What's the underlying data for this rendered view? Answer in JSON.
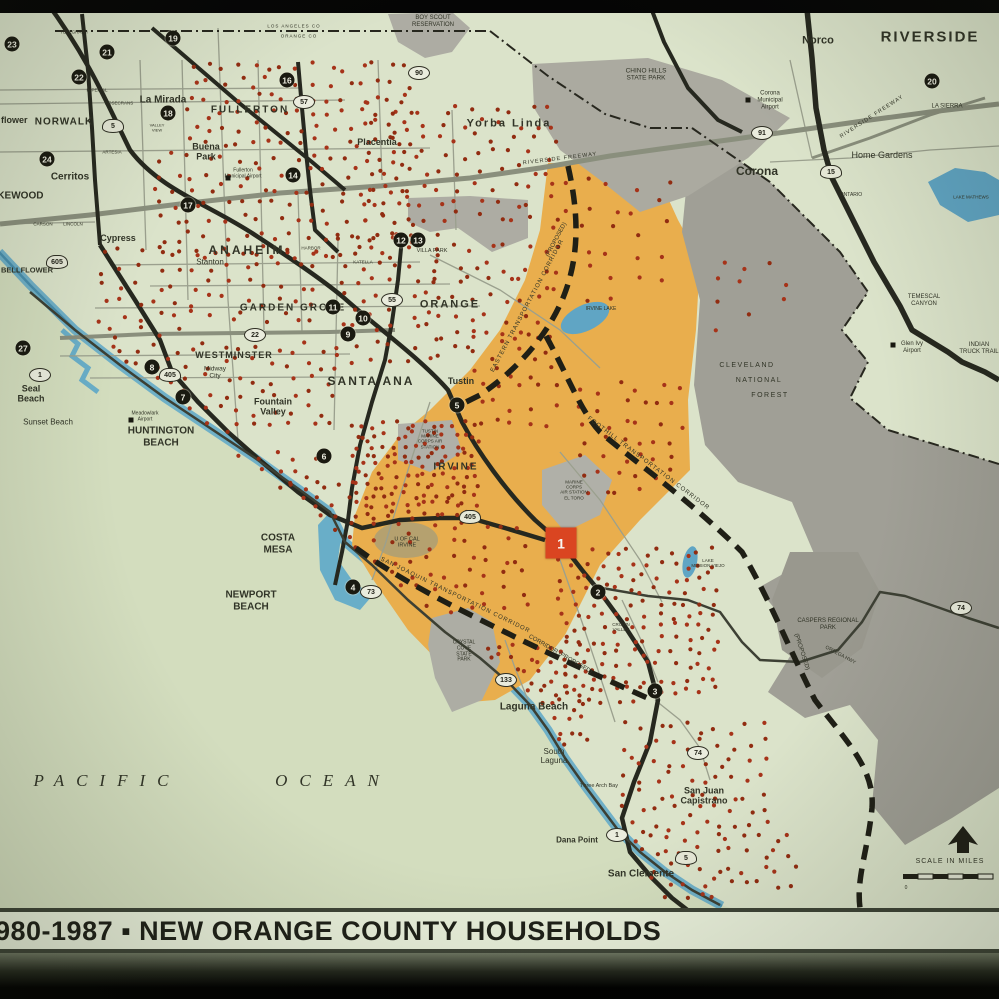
{
  "slide": {
    "title": "980-1987 ▪ NEW ORANGE COUNTY HOUSEHOLDS"
  },
  "map": {
    "colors": {
      "land": "#e1e9d2",
      "ocean": "#d8e3c6",
      "coast_blue": "#69b1d0",
      "coast_blue_dark": "#4690b4",
      "study_area_orange": "#f0b14e",
      "forest_gray": "#a3a29b",
      "park_gray": "#aeada6",
      "base_gray": "#b4b4ae",
      "lake_blue": "#5fa8cc",
      "dot_red": "#a93018",
      "freeway_black": "#22241e",
      "freeway_gray": "#8c9181",
      "marker_black": "#16160f",
      "site1_red": "#e04320",
      "band_bg": "#e7eed9"
    },
    "scale": {
      "label": "SCALE IN MILES",
      "zero": "0"
    },
    "special_marker": {
      "n": "1",
      "x": 561,
      "y": 543
    },
    "markers": [
      {
        "n": "2",
        "x": 598,
        "y": 592
      },
      {
        "n": "3",
        "x": 655,
        "y": 691
      },
      {
        "n": "4",
        "x": 353,
        "y": 587
      },
      {
        "n": "5",
        "x": 457,
        "y": 405
      },
      {
        "n": "6",
        "x": 324,
        "y": 456
      },
      {
        "n": "7",
        "x": 183,
        "y": 397
      },
      {
        "n": "8",
        "x": 152,
        "y": 367
      },
      {
        "n": "9",
        "x": 348,
        "y": 334
      },
      {
        "n": "10",
        "x": 363,
        "y": 318
      },
      {
        "n": "11",
        "x": 333,
        "y": 307
      },
      {
        "n": "12",
        "x": 401,
        "y": 240
      },
      {
        "n": "13",
        "x": 418,
        "y": 240
      },
      {
        "n": "14",
        "x": 293,
        "y": 175
      },
      {
        "n": "16",
        "x": 287,
        "y": 80
      },
      {
        "n": "17",
        "x": 188,
        "y": 205
      },
      {
        "n": "18",
        "x": 168,
        "y": 113
      },
      {
        "n": "19",
        "x": 173,
        "y": 38
      },
      {
        "n": "20",
        "x": 932,
        "y": 81
      },
      {
        "n": "21",
        "x": 107,
        "y": 52
      },
      {
        "n": "22",
        "x": 79,
        "y": 77
      },
      {
        "n": "23",
        "x": 12,
        "y": 44
      },
      {
        "n": "24",
        "x": 47,
        "y": 159
      },
      {
        "n": "27",
        "x": 23,
        "y": 348
      }
    ],
    "route_shields": [
      {
        "n": "5",
        "x": 113,
        "y": 126,
        "t": "i"
      },
      {
        "n": "5",
        "x": 686,
        "y": 858,
        "t": "i"
      },
      {
        "n": "405",
        "x": 170,
        "y": 375,
        "t": "i"
      },
      {
        "n": "405",
        "x": 470,
        "y": 517,
        "t": "i"
      },
      {
        "n": "605",
        "x": 57,
        "y": 262,
        "t": "i"
      },
      {
        "n": "15",
        "x": 831,
        "y": 172,
        "t": "i"
      },
      {
        "n": "91",
        "x": 762,
        "y": 133,
        "t": "s"
      },
      {
        "n": "22",
        "x": 255,
        "y": 335,
        "t": "s"
      },
      {
        "n": "55",
        "x": 392,
        "y": 300,
        "t": "s"
      },
      {
        "n": "57",
        "x": 304,
        "y": 102,
        "t": "s"
      },
      {
        "n": "74",
        "x": 698,
        "y": 753,
        "t": "s"
      },
      {
        "n": "74",
        "x": 961,
        "y": 608,
        "t": "s"
      },
      {
        "n": "1",
        "x": 40,
        "y": 375,
        "t": "s"
      },
      {
        "n": "1",
        "x": 617,
        "y": 835,
        "t": "s"
      },
      {
        "n": "133",
        "x": 506,
        "y": 680,
        "t": "s"
      },
      {
        "n": "73",
        "x": 371,
        "y": 592,
        "t": "s"
      },
      {
        "n": "90",
        "x": 419,
        "y": 73,
        "t": "s"
      }
    ],
    "airport_icons": [
      {
        "x": 228,
        "y": 178
      },
      {
        "x": 131,
        "y": 420
      },
      {
        "x": 748,
        "y": 100
      },
      {
        "x": 893,
        "y": 345
      }
    ],
    "labels": [
      {
        "id": "riverside",
        "t": "RIVERSIDE",
        "x": 930,
        "y": 37,
        "s": 15,
        "w": 700,
        "sp": 2
      },
      {
        "id": "norco",
        "t": "Norco",
        "x": 818,
        "y": 41,
        "s": 11,
        "w": 700
      },
      {
        "id": "corona",
        "t": "Corona",
        "x": 757,
        "y": 172,
        "s": 12,
        "w": 700
      },
      {
        "id": "home-gardens",
        "t": "Home Gardens",
        "x": 882,
        "y": 155,
        "s": 9
      },
      {
        "id": "la-sierra",
        "t": "LA SIERRA",
        "x": 947,
        "y": 107,
        "s": 6
      },
      {
        "id": "ontario",
        "t": "ONTARIO",
        "x": 851,
        "y": 196,
        "s": 5
      },
      {
        "id": "corona-airport",
        "t": "Corona\nMunicipal\nAirport",
        "x": 770,
        "y": 101,
        "s": 6
      },
      {
        "id": "chino-hills-sp",
        "t": "CHINO HILLS\nSTATE PARK",
        "x": 646,
        "y": 75,
        "s": 6.5
      },
      {
        "id": "boy-scout",
        "t": "BOY SCOUT\nRESERVATION",
        "x": 433,
        "y": 22,
        "s": 6
      },
      {
        "id": "cleveland",
        "t": "CLEVELAND",
        "x": 747,
        "y": 366,
        "s": 7,
        "sp": 1.5
      },
      {
        "id": "national",
        "t": "NATIONAL",
        "x": 759,
        "y": 381,
        "s": 7,
        "sp": 1.5
      },
      {
        "id": "forest",
        "t": "FOREST",
        "x": 770,
        "y": 396,
        "s": 7,
        "sp": 1.5
      },
      {
        "id": "temescal",
        "t": "TEMESCAL\nCANYON",
        "x": 924,
        "y": 301,
        "s": 6
      },
      {
        "id": "glen-ivy",
        "t": "Glen Ivy\nAirport",
        "x": 912,
        "y": 348,
        "s": 6
      },
      {
        "id": "indian-truck",
        "t": "INDIAN\nTRUCK TRAIL",
        "x": 979,
        "y": 349,
        "s": 6
      },
      {
        "id": "lake-mathews",
        "t": "LAKE MATHEWS",
        "x": 971,
        "y": 197,
        "s": 4.5
      },
      {
        "id": "caspers",
        "t": "CASPERS REGIONAL\nPARK",
        "x": 828,
        "y": 625,
        "s": 6
      },
      {
        "id": "irvine-lake",
        "t": "IRVINE LAKE",
        "x": 601,
        "y": 310,
        "s": 5
      },
      {
        "id": "lake-mission-viejo",
        "t": "LAKE\nMISSION VIEJO",
        "x": 708,
        "y": 563,
        "s": 4.5
      },
      {
        "id": "pacific",
        "t": "PACIFIC",
        "x": 107,
        "y": 781,
        "s": 17,
        "i": 1,
        "f": "serif",
        "sp": 12
      },
      {
        "id": "ocean",
        "t": "OCEAN",
        "x": 333,
        "y": 781,
        "s": 17,
        "i": 1,
        "f": "serif",
        "sp": 12
      },
      {
        "id": "norwalk",
        "t": "NORWALK",
        "x": 64,
        "y": 122,
        "s": 10,
        "w": 700,
        "sp": 1
      },
      {
        "id": "la-mirada",
        "t": "La Mirada",
        "x": 163,
        "y": 100,
        "s": 10,
        "w": 700
      },
      {
        "id": "cerritos",
        "t": "Cerritos",
        "x": 70,
        "y": 177,
        "s": 10,
        "w": 700
      },
      {
        "id": "lakewood",
        "t": "LAKEWOOD",
        "x": -16,
        "y": 196,
        "s": 10,
        "w": 700,
        "a": "l"
      },
      {
        "id": "bellflower-cut",
        "t": "flower",
        "x": 1,
        "y": 120,
        "s": 9,
        "w": 700,
        "a": "l"
      },
      {
        "id": "bellflower",
        "t": "BELLFLOWER",
        "x": 1,
        "y": 271,
        "s": 7.5,
        "w": 700,
        "a": "l"
      },
      {
        "id": "fullerton",
        "t": "FULLERTON",
        "x": 250,
        "y": 110,
        "s": 10,
        "w": 700,
        "sp": 2
      },
      {
        "id": "buena-park",
        "t": "Buena\nPark",
        "x": 206,
        "y": 152,
        "s": 9,
        "w": 700
      },
      {
        "id": "fullerton-airport",
        "t": "Fullerton\nMunicipal Airport",
        "x": 243,
        "y": 174,
        "s": 5
      },
      {
        "id": "cypress",
        "t": "Cypress",
        "x": 118,
        "y": 238,
        "s": 9,
        "w": 700
      },
      {
        "id": "anaheim",
        "t": "ANAHEIM",
        "x": 247,
        "y": 251,
        "s": 12,
        "w": 700,
        "sp": 3
      },
      {
        "id": "stanton",
        "t": "Stanton",
        "x": 210,
        "y": 262,
        "s": 8
      },
      {
        "id": "garden-grove",
        "t": "GARDEN GROVE",
        "x": 293,
        "y": 308,
        "s": 10,
        "w": 700,
        "sp": 2
      },
      {
        "id": "orange",
        "t": "ORANGE",
        "x": 450,
        "y": 305,
        "s": 11,
        "w": 700,
        "sp": 2
      },
      {
        "id": "villa-park",
        "t": "VILLA PARK",
        "x": 432,
        "y": 251,
        "s": 5.5
      },
      {
        "id": "westminster",
        "t": "WESTMINSTER",
        "x": 234,
        "y": 355,
        "s": 9,
        "w": 700,
        "sp": 1
      },
      {
        "id": "midway-city",
        "t": "Midway\nCity",
        "x": 215,
        "y": 373,
        "s": 6.5
      },
      {
        "id": "fountain-valley",
        "t": "Fountain\nValley",
        "x": 273,
        "y": 407,
        "s": 9,
        "w": 700
      },
      {
        "id": "santa-ana",
        "t": "SANTA ANA",
        "x": 371,
        "y": 382,
        "s": 12,
        "w": 700,
        "sp": 2
      },
      {
        "id": "tustin",
        "t": "Tustin",
        "x": 461,
        "y": 381,
        "s": 9,
        "w": 700
      },
      {
        "id": "irvine",
        "t": "IRVINE",
        "x": 456,
        "y": 467,
        "s": 10,
        "w": 700,
        "sp": 2
      },
      {
        "id": "costa-mesa",
        "t": "COSTA\nMESA",
        "x": 278,
        "y": 544,
        "s": 10,
        "w": 700
      },
      {
        "id": "newport-beach",
        "t": "NEWPORT\nBEACH",
        "x": 251,
        "y": 601,
        "s": 10,
        "w": 700
      },
      {
        "id": "huntington-beach",
        "t": "HUNTINGTON\nBEACH",
        "x": 161,
        "y": 437,
        "s": 10,
        "w": 700
      },
      {
        "id": "seal-beach",
        "t": "Seal\nBeach",
        "x": 31,
        "y": 394,
        "s": 9,
        "w": 700
      },
      {
        "id": "sunset-beach",
        "t": "Sunset Beach",
        "x": 48,
        "y": 422,
        "s": 8
      },
      {
        "id": "meadowlark",
        "t": "Meadowlark\nAirport",
        "x": 145,
        "y": 417,
        "s": 5
      },
      {
        "id": "laguna-beach",
        "t": "Laguna Beach",
        "x": 534,
        "y": 707,
        "s": 10,
        "w": 700
      },
      {
        "id": "south-laguna",
        "t": "South\nLaguna",
        "x": 554,
        "y": 756,
        "s": 8
      },
      {
        "id": "three-arch-bay",
        "t": "Three Arch Bay",
        "x": 599,
        "y": 786,
        "s": 5.5
      },
      {
        "id": "dana-point",
        "t": "Dana Point",
        "x": 577,
        "y": 840,
        "s": 8,
        "w": 700
      },
      {
        "id": "san-clemente",
        "t": "San Clemente",
        "x": 641,
        "y": 874,
        "s": 10,
        "w": 700
      },
      {
        "id": "san-juan-capistrano",
        "t": "San Juan\nCapistrano",
        "x": 704,
        "y": 796,
        "s": 9,
        "w": 700
      },
      {
        "id": "yorba-linda",
        "t": "Yorba Linda",
        "x": 509,
        "y": 124,
        "s": 11,
        "w": 700,
        "sp": 2
      },
      {
        "id": "placentia",
        "t": "Placentia",
        "x": 377,
        "y": 142,
        "s": 9,
        "w": 700
      },
      {
        "id": "uc-irvine",
        "t": "U OF CAL\nIRVINE",
        "x": 407,
        "y": 543,
        "s": 5.5
      },
      {
        "id": "tustin-mcas",
        "t": "TUSTIN\nMARINE\nCORPS AIR\nSTATION",
        "x": 430,
        "y": 439,
        "s": 4.5
      },
      {
        "id": "el-toro-mcas",
        "t": "MARINE\nCORPS\nAIR STATION\nEL TORO",
        "x": 574,
        "y": 490,
        "s": 4.5
      },
      {
        "id": "crystal-cove",
        "t": "CRYSTAL\nCOVE\nSTATE\nPARK",
        "x": 464,
        "y": 652,
        "s": 5
      },
      {
        "id": "crown-valley",
        "t": "CROWN\nVALLEY",
        "x": 621,
        "y": 627,
        "s": 4.5
      },
      {
        "id": "scale-label",
        "t": "SCALE IN MILES",
        "x": 950,
        "y": 862,
        "s": 7,
        "sp": 1
      },
      {
        "id": "scale-zero",
        "t": "0",
        "x": 906,
        "y": 889,
        "s": 5
      },
      {
        "id": "eastern-corridor",
        "t": "EASTERN TRANSPORTATION CORRIDOR",
        "x": 528,
        "y": 306,
        "s": 6,
        "r": -62,
        "sp": 1
      },
      {
        "id": "eastern-proposed",
        "t": "(PROPOSED)",
        "x": 557,
        "y": 240,
        "s": 6,
        "r": -62
      },
      {
        "id": "foothill-corridor",
        "t": "FOOTHILL TRANSPORTATION CORRIDOR",
        "x": 648,
        "y": 464,
        "s": 6,
        "r": 37,
        "sp": 1
      },
      {
        "id": "foothill-proposed",
        "t": "(PROPOSED)",
        "x": 801,
        "y": 652,
        "s": 6,
        "r": 72
      },
      {
        "id": "san-joaquin-corridor",
        "t": "SAN JOAQUIN TRANSPORTATION CORRIDOR",
        "x": 455,
        "y": 596,
        "s": 6,
        "r": 26,
        "sp": 1
      },
      {
        "id": "sj-proposed",
        "t": "CORRIDOR (PROPOSED)",
        "x": 560,
        "y": 655,
        "s": 6,
        "r": 30
      },
      {
        "id": "riverside-fwy-1",
        "t": "RIVERSIDE FREEWAY",
        "x": 560,
        "y": 159,
        "s": 5.5,
        "r": -7,
        "sp": 1
      },
      {
        "id": "riverside-fwy-2",
        "t": "RIVERSIDE FREEWAY",
        "x": 872,
        "y": 117,
        "s": 5.5,
        "r": -33,
        "sp": 1
      },
      {
        "id": "ortega-hwy",
        "t": "ORTEGA HWY",
        "x": 840,
        "y": 656,
        "s": 5,
        "r": 28
      },
      {
        "id": "la-county",
        "t": "LOS ANGELES CO",
        "x": 294,
        "y": 26,
        "s": 4.5,
        "sp": 1
      },
      {
        "id": "orange-county",
        "t": "ORANGE CO",
        "x": 299,
        "y": 36,
        "s": 4.5,
        "sp": 1
      },
      {
        "id": "st-imperial",
        "t": "IMPERIAL",
        "x": 97,
        "y": 90,
        "s": 4.5
      },
      {
        "id": "st-rosecrans",
        "t": "ROSECRANS",
        "x": 119,
        "y": 103,
        "s": 4.5
      },
      {
        "id": "st-artesia",
        "t": "ARTESIA",
        "x": 112,
        "y": 152,
        "s": 4.5
      },
      {
        "id": "st-carson",
        "t": "CARSON",
        "x": 43,
        "y": 224,
        "s": 4.5
      },
      {
        "id": "st-lincoln",
        "t": "LINCOLN",
        "x": 73,
        "y": 224,
        "s": 4.5
      },
      {
        "id": "st-katella",
        "t": "KATELLA",
        "x": 363,
        "y": 262,
        "s": 4.5
      },
      {
        "id": "st-harbor",
        "t": "HARBOR",
        "x": 311,
        "y": 248,
        "s": 4.5
      },
      {
        "id": "st-valley-view",
        "t": "VALLEY\nVIEW",
        "x": 157,
        "y": 128,
        "s": 4
      },
      {
        "id": "st-telegraph",
        "t": "TELEGRAPH",
        "x": 74,
        "y": 32,
        "s": 4.5
      }
    ],
    "dot_clusters": [
      {
        "x": 185,
        "y": 60,
        "w": 230,
        "h": 90,
        "n": 90
      },
      {
        "x": 150,
        "y": 150,
        "w": 270,
        "h": 110,
        "n": 110
      },
      {
        "x": 95,
        "y": 245,
        "w": 230,
        "h": 95,
        "n": 70
      },
      {
        "x": 360,
        "y": 100,
        "w": 200,
        "h": 140,
        "n": 90
      },
      {
        "x": 430,
        "y": 240,
        "w": 120,
        "h": 120,
        "n": 45
      },
      {
        "x": 95,
        "y": 340,
        "w": 240,
        "h": 110,
        "n": 90
      },
      {
        "x": 140,
        "y": 450,
        "w": 180,
        "h": 90,
        "n": 55
      },
      {
        "x": 230,
        "y": 480,
        "w": 130,
        "h": 90,
        "n": 45
      },
      {
        "x": 330,
        "y": 230,
        "w": 110,
        "h": 150,
        "n": 55
      },
      {
        "x": 350,
        "y": 420,
        "w": 130,
        "h": 100,
        "n": 130
      },
      {
        "x": 370,
        "y": 520,
        "w": 160,
        "h": 110,
        "n": 55
      },
      {
        "x": 545,
        "y": 175,
        "w": 130,
        "h": 130,
        "n": 28
      },
      {
        "x": 470,
        "y": 330,
        "w": 90,
        "h": 100,
        "n": 30
      },
      {
        "x": 555,
        "y": 545,
        "w": 165,
        "h": 165,
        "n": 150
      },
      {
        "x": 480,
        "y": 640,
        "w": 110,
        "h": 120,
        "n": 75
      },
      {
        "x": 620,
        "y": 720,
        "w": 150,
        "h": 115,
        "n": 70
      },
      {
        "x": 615,
        "y": 830,
        "w": 185,
        "h": 75,
        "n": 55
      },
      {
        "x": 60,
        "y": 330,
        "w": 60,
        "h": 90,
        "n": 10
      },
      {
        "x": 700,
        "y": 250,
        "w": 90,
        "h": 90,
        "n": 10
      },
      {
        "x": 575,
        "y": 380,
        "w": 110,
        "h": 120,
        "n": 40
      }
    ]
  }
}
